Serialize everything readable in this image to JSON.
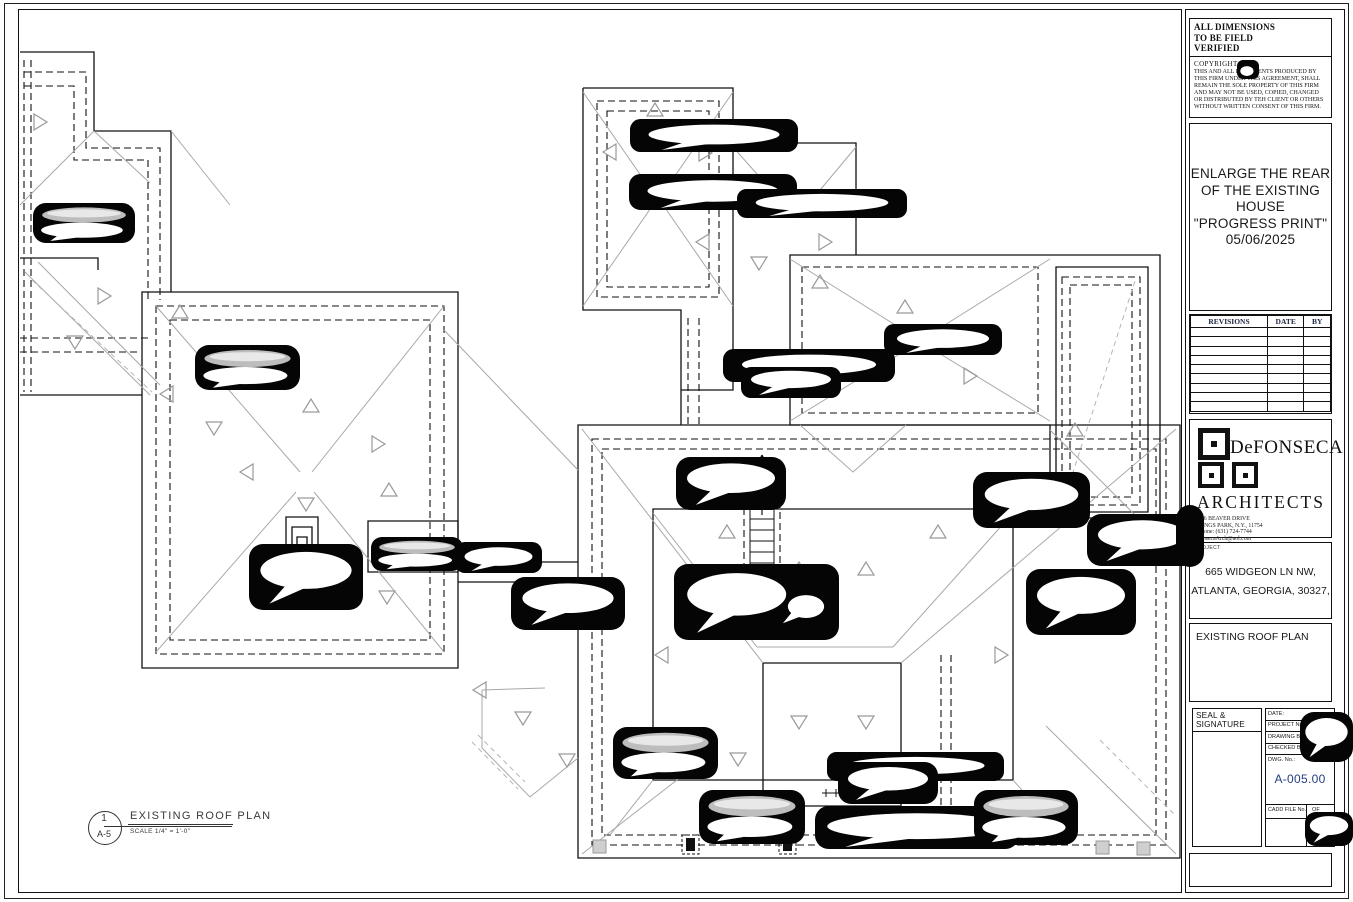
{
  "title_block": {
    "dimensions_note": "ALL DIMENSIONS\nTO BE FIELD\nVERIFIED",
    "copyright": {
      "heading": "COPYRIGHT",
      "body": "THIS AND ALL DOCUMENTS  PRODUCED BY THIS FIRM UNDER THIS AGREEMENT, SHALL REMAIN THE SOLE PROPERTY OF THIS FIRM AND MAY NOT BE USED, COPIED, CHANGED OR DISTRIBUTED BY TEH CLIENT OR OTHERS WITHOUT WRITTEN CONSENT OF THIS FIRM."
    },
    "print_title": {
      "lines": [
        "ENLARGE THE REAR",
        "OF THE EXISTING",
        "HOUSE",
        "\"PROGRESS PRINT\"",
        "05/06/2025"
      ]
    },
    "revisions_table": {
      "headers": [
        "REVISIONS",
        "DATE",
        "BY"
      ],
      "empty_rows": 9
    },
    "architect": {
      "name_line1": "DeFONSECA",
      "name_line2": "ARCHITECTS",
      "address_line1": "166 BEAVER DRIVE",
      "address_line2": "KINGS PARK, N.Y., 11754",
      "phone": "Phone: (631) 724-7744",
      "email": "fonsecaArch@aol.com"
    },
    "project": {
      "label": "PROJECT",
      "address_line1": "665 WIDGEON LN NW,",
      "address_line2": "ATLANTA, GEORGIA, 30327,"
    },
    "drawing_title": "EXISTING ROOF PLAN",
    "seal": {
      "label": "SEAL & SIGNATURE",
      "fields": [
        "DATE:",
        "PROJECT No.",
        "DRAWING BY:",
        "CHECKED BY:",
        "DWG. No.:"
      ],
      "dwg_no": "A-005.00",
      "cadd_label": "CADD FILE No.",
      "of_label": "OF"
    }
  },
  "drawing_label": {
    "detail_number": "1",
    "sheet_ref": "A-5",
    "title": "EXISTING ROOF PLAN",
    "scale": "SCALE 1/4\" = 1'-0\""
  },
  "colors": {
    "dwg_no_accent": "#24407e",
    "line_black": "#111111",
    "line_gray": "#a8a8a8",
    "blob_fill": "#050505"
  }
}
